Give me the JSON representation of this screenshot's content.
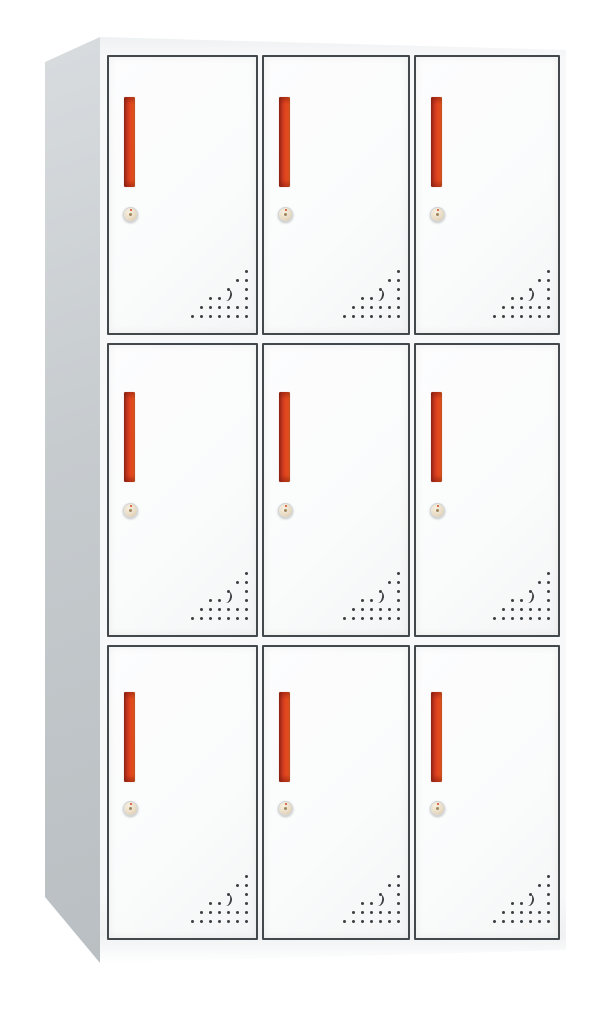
{
  "scene": {
    "background_color": "#ffffff",
    "object": "nine-door metal locker cabinet, white body with red vertical handles, photographed slightly from the left"
  },
  "cabinet": {
    "type": "9-door-locker",
    "rows": 3,
    "columns": 3,
    "colors": {
      "background": "#ffffff",
      "body_front": "#f7f8f9",
      "top_edge": "#eef1f2",
      "base": "#eff1f2",
      "door_face": "#fafbfb",
      "door_frame": "#43484d",
      "side_top": "#d8dcdf",
      "side_bottom": "#b9bfc2",
      "handle_dark": "#9a2c1b",
      "handle_main": "#dd4120",
      "handle_light": "#f4742e",
      "lock_ring": "#cfd3d5",
      "lock_center": "#e9dcc6",
      "vent_dot": "#3c4043"
    },
    "doors": [
      {
        "id": "locker-door-r1c1",
        "row": 1,
        "col": 1,
        "handle": "red-vertical-bar",
        "lock": "cam-lock",
        "vents": "corner-dot-triangle"
      },
      {
        "id": "locker-door-r1c2",
        "row": 1,
        "col": 2,
        "handle": "red-vertical-bar",
        "lock": "cam-lock",
        "vents": "corner-dot-triangle"
      },
      {
        "id": "locker-door-r1c3",
        "row": 1,
        "col": 3,
        "handle": "red-vertical-bar",
        "lock": "cam-lock",
        "vents": "corner-dot-triangle"
      },
      {
        "id": "locker-door-r2c1",
        "row": 2,
        "col": 1,
        "handle": "red-vertical-bar",
        "lock": "cam-lock",
        "vents": "corner-dot-triangle"
      },
      {
        "id": "locker-door-r2c2",
        "row": 2,
        "col": 2,
        "handle": "red-vertical-bar",
        "lock": "cam-lock",
        "vents": "corner-dot-triangle"
      },
      {
        "id": "locker-door-r2c3",
        "row": 2,
        "col": 3,
        "handle": "red-vertical-bar",
        "lock": "cam-lock",
        "vents": "corner-dot-triangle"
      },
      {
        "id": "locker-door-r3c1",
        "row": 3,
        "col": 1,
        "handle": "red-vertical-bar",
        "lock": "cam-lock",
        "vents": "corner-dot-triangle"
      },
      {
        "id": "locker-door-r3c2",
        "row": 3,
        "col": 2,
        "handle": "red-vertical-bar",
        "lock": "cam-lock",
        "vents": "corner-dot-triangle"
      },
      {
        "id": "locker-door-r3c3",
        "row": 3,
        "col": 3,
        "handle": "red-vertical-bar",
        "lock": "cam-lock",
        "vents": "corner-dot-triangle"
      }
    ],
    "vent_pattern": [
      "......o",
      ".....oo",
      "....o.o",
      "..oo..o",
      ".oooooo",
      "ooooooo"
    ],
    "vent_cell_px": 9
  }
}
